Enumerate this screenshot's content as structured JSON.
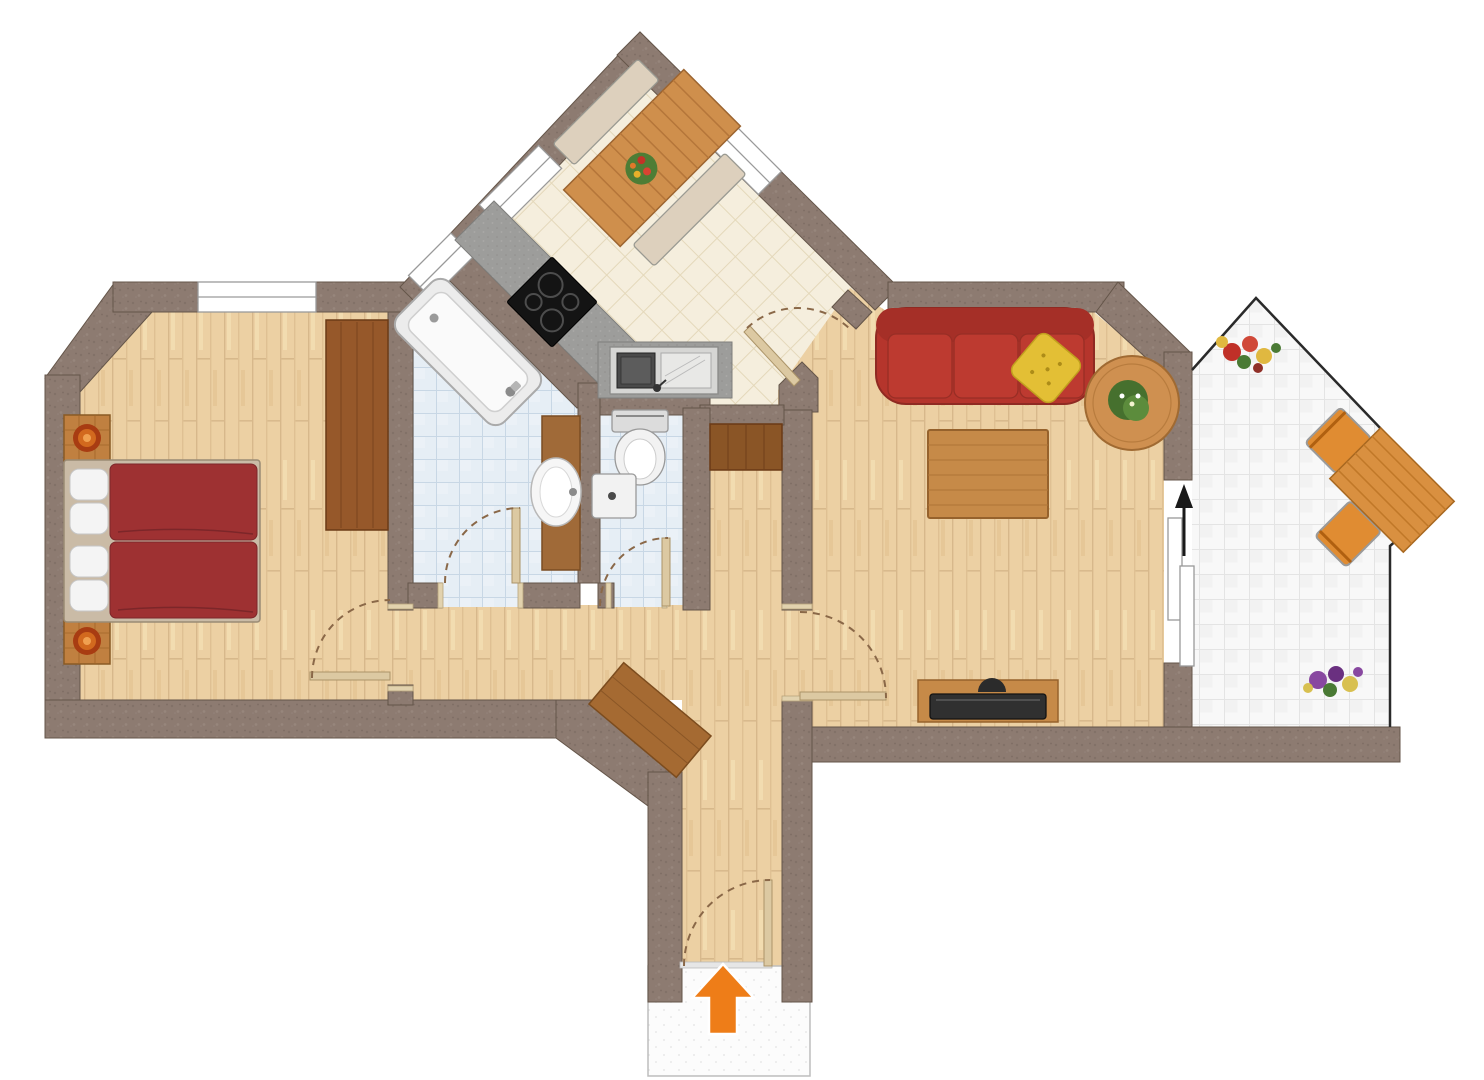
{
  "plan": {
    "label": "Apartment floor plan",
    "wall_color": "#8d7b71",
    "background": "#ffffff"
  },
  "rooms": [
    {
      "id": "bedroom",
      "label": "Bedroom",
      "floor": "wood-parquet",
      "floor_color": "#ecd0a3"
    },
    {
      "id": "bathroom",
      "label": "Bathroom",
      "floor": "blue-tile",
      "floor_color": "#e6eef5"
    },
    {
      "id": "wc",
      "label": "WC",
      "floor": "blue-tile",
      "floor_color": "#e6eef5"
    },
    {
      "id": "kitchen",
      "label": "Kitchen / Dining",
      "floor": "cream-tile",
      "floor_color": "#f5eedd"
    },
    {
      "id": "living-room",
      "label": "Living room",
      "floor": "wood-parquet",
      "floor_color": "#ecd0a3"
    },
    {
      "id": "hallway",
      "label": "Hallway / Entrance",
      "floor": "wood-parquet",
      "floor_color": "#ecd0a3"
    },
    {
      "id": "balcony",
      "label": "Balcony",
      "floor": "white-tile",
      "floor_color": "#f8f8f8"
    }
  ],
  "furniture": {
    "bedroom": [
      "double-bed",
      "pillows",
      "nightstand-with-plant",
      "nightstand-with-plant",
      "wardrobe"
    ],
    "bathroom": [
      "bathtub",
      "washbasin-vanity"
    ],
    "wc": [
      "toilet",
      "corner-washbasin"
    ],
    "kitchen": [
      "corner-counter-with-cooktop",
      "steel-sink-unit",
      "dining-table",
      "dining-bench",
      "dining-bench",
      "flower-centerpiece"
    ],
    "living": [
      "sofa",
      "throw-pillow",
      "coffee-table",
      "side-table-with-plant",
      "tv-lowboard",
      "flat-tv"
    ],
    "hallway": [
      "built-in-cabinet",
      "sideboard"
    ],
    "balcony": [
      "garden-table",
      "garden-chair",
      "garden-chair",
      "flower-box",
      "flower-box"
    ]
  },
  "colors": {
    "bed_red": "#9e3132",
    "sofa_red": "#b5352c",
    "pillow_yellow": "#e3bf35",
    "furniture_wood": "#c68a48",
    "dark_wood": "#96582a",
    "counter_gray": "#9d9d9b",
    "arrow_orange": "#ee7d18",
    "arrow_black": "#1a1a1a",
    "door_swing": "#8a6848"
  },
  "doors": [
    "bedroom-door",
    "bathroom-door",
    "wc-door",
    "kitchen-door",
    "living-room-door",
    "balcony-sliding-door",
    "entrance-door"
  ],
  "windows": [
    "bedroom-window",
    "bathroom-window",
    "kitchen-window-nw",
    "kitchen-window-ne"
  ],
  "arrows": [
    {
      "id": "entrance-arrow",
      "direction": "up",
      "color": "#ee7d18"
    },
    {
      "id": "balcony-arrow",
      "direction": "up",
      "color": "#1a1a1a"
    }
  ]
}
